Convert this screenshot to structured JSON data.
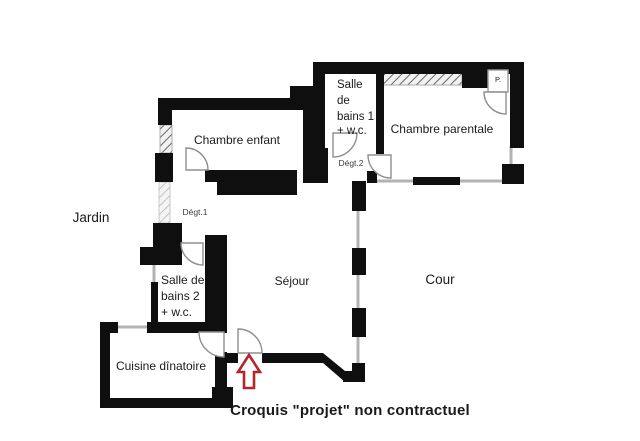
{
  "plan": {
    "rooms": {
      "chambre_enfant": "Chambre enfant",
      "salle_de_bains_1": {
        "lines": [
          "Salle",
          "de",
          "bains 1",
          "+ w.c."
        ]
      },
      "chambre_parentale": "Chambre parentale",
      "placard": "P.",
      "degagement_1": "Dégt.1",
      "degagement_2": "Dégt.2",
      "salle_de_bains_2": {
        "lines": [
          "Salle de",
          "bains 2",
          "+ w.c."
        ]
      },
      "sejour": "Séjour",
      "cuisine": "Cuisine dînatoire"
    },
    "exterior": {
      "jardin": "Jardin",
      "cour": "Cour"
    },
    "caption": "Croquis \"projet\" non contractuel",
    "colors": {
      "wall": "#0f0f0f",
      "window_line": "#b3b3b3",
      "door_stroke": "#8f8f8f",
      "arrow_red": "#b6252a",
      "background": "#ffffff"
    }
  }
}
